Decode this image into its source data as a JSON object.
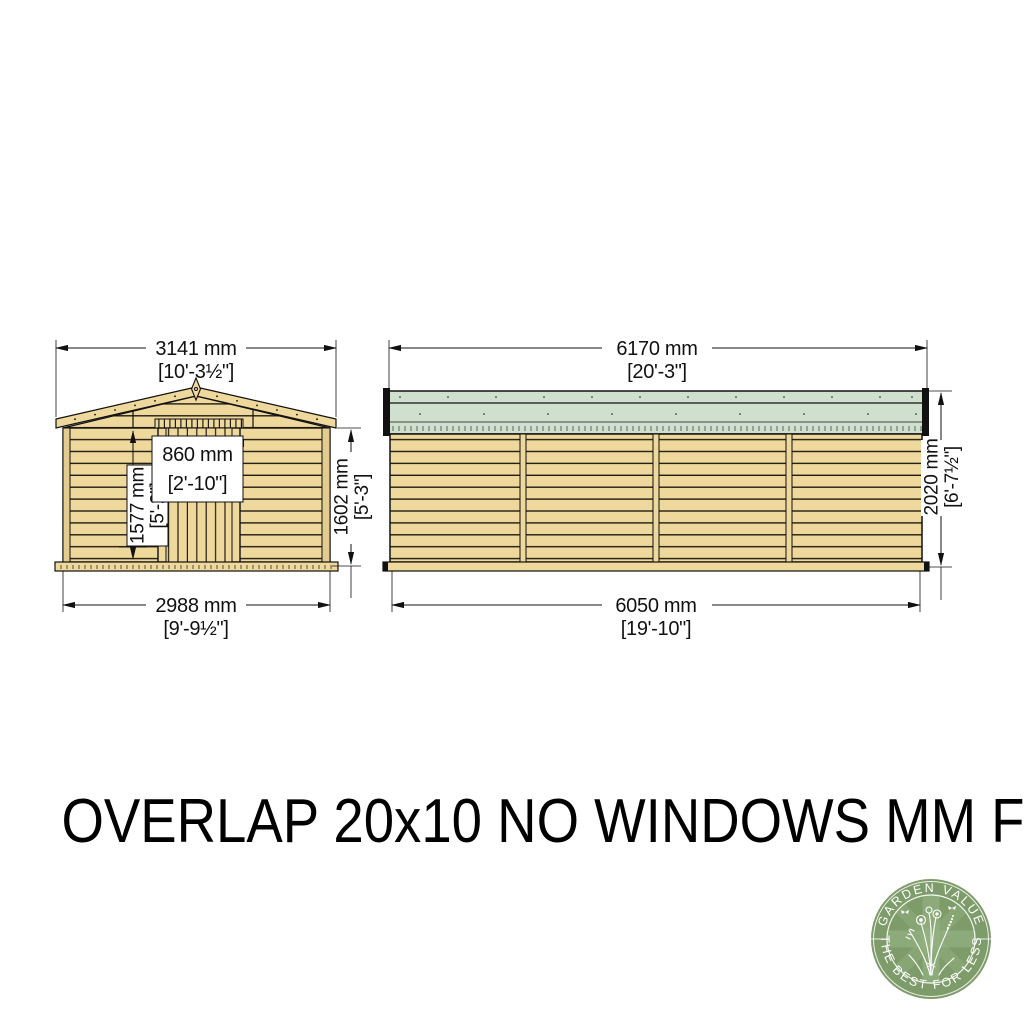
{
  "title": "OVERLAP 20x10 NO WINDOWS MM FT",
  "front_elevation": {
    "roof_width_mm": "3141 mm",
    "roof_width_ft": "[10'-3½\"]",
    "door_width_mm": "860 mm",
    "door_width_ft": "[2'-10\"]",
    "door_height_mm": "1577 mm",
    "door_height_ft": "[5'-2\"]",
    "eaves_height_mm": "1602 mm",
    "eaves_height_ft": "[5'-3\"]",
    "base_width_mm": "2988 mm",
    "base_width_ft": "[9'-9½\"]"
  },
  "side_elevation": {
    "roof_length_mm": "6170 mm",
    "roof_length_ft": "[20'-3\"]",
    "height_mm": "2020 mm",
    "height_ft": "[6'-7½\"]",
    "base_length_mm": "6050 mm",
    "base_length_ft": "[19'-10\"]"
  },
  "logo": {
    "arc_top": "GARDEN VALUE",
    "arc_bottom": "THE BEST FOR LESS"
  },
  "colors": {
    "wood": "#eed89c",
    "roof_green": "#cfe0cf",
    "logo_green": "#7e9c6a",
    "line": "#111111"
  }
}
